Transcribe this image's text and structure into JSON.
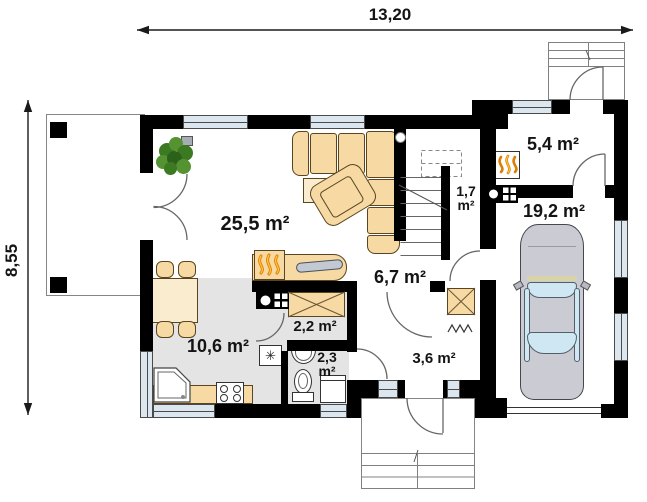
{
  "plan": {
    "dimensions": {
      "width": "13,20",
      "height": "8,55"
    },
    "rooms": {
      "living": {
        "area": "25,5 m²"
      },
      "kitchen": {
        "area": "10,6 m²"
      },
      "pantry": {
        "area": "2,2 m²"
      },
      "bathroom": {
        "area_value": "2,3",
        "area_unit": "m²"
      },
      "hall": {
        "area": "6,7 m²"
      },
      "vestibule": {
        "area": "3,6 m²"
      },
      "stairs": {
        "area_value": "1,7",
        "area_unit": "m²"
      },
      "boiler": {
        "area": "5,4 m²"
      },
      "garage": {
        "area": "19,2 m²"
      }
    },
    "icons": {
      "fridge_glyph": "✳",
      "fireplace": "flames-icon",
      "furnace": "flames-icon",
      "stove": "four-burners-icon",
      "chimney": "circle-grid-icon"
    },
    "colors": {
      "wall": "#000000",
      "floor_tile": "#e4e4e4",
      "furniture": "#f6d9a3",
      "window_glass": "#dce6ee",
      "flame": "#e07c00",
      "car_body": "#cbccd3",
      "plant": "#3c7a22"
    }
  }
}
